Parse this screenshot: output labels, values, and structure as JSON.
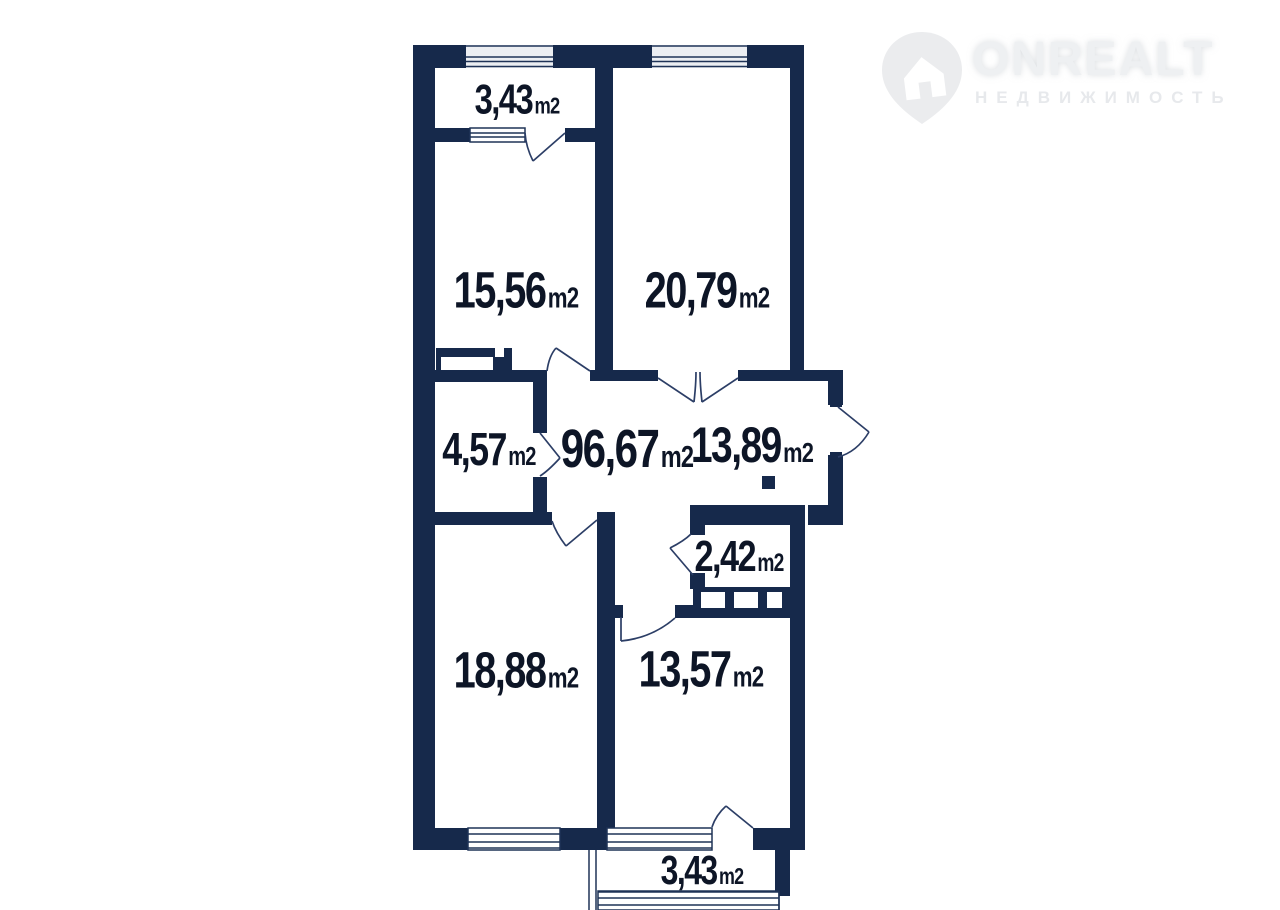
{
  "logo": {
    "brand": "ONREALT",
    "subtitle": "НЕДВИЖИМОСТЬ"
  },
  "plan": {
    "unit": "m2",
    "labels": [
      {
        "id": "balcony-top",
        "area": "3,43"
      },
      {
        "id": "room-15-56",
        "area": "15,56"
      },
      {
        "id": "room-20-79",
        "area": "20,79"
      },
      {
        "id": "room-4-57",
        "area": "4,57"
      },
      {
        "id": "total-area",
        "area": "96,67"
      },
      {
        "id": "hall-13-89",
        "area": "13,89"
      },
      {
        "id": "bath-2-42",
        "area": "2,42"
      },
      {
        "id": "room-18-88",
        "area": "18,88"
      },
      {
        "id": "room-13-57",
        "area": "13,57"
      },
      {
        "id": "balcony-bottom",
        "area": "3,43"
      }
    ]
  },
  "colors": {
    "wall": "#16294b",
    "label": "#0d1526",
    "logo_gray": "#ebecee"
  }
}
